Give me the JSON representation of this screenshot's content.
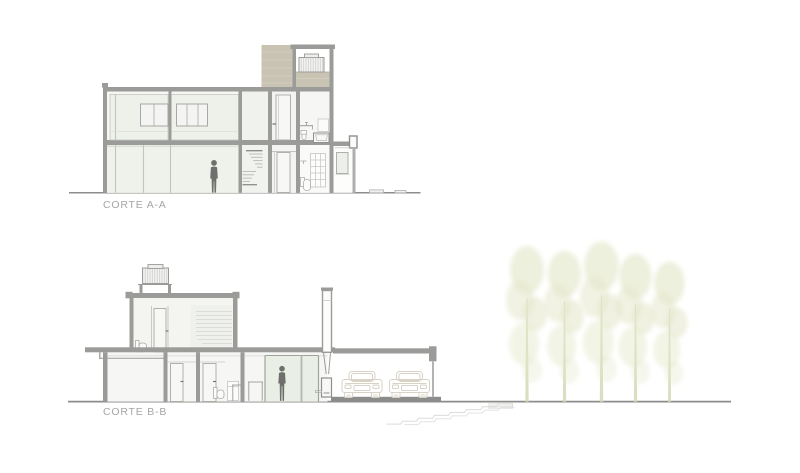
{
  "page": {
    "background": "#ffffff",
    "kind": "architectural-sections-sheet"
  },
  "sections": [
    {
      "id": "corte-aa",
      "label": "CORTE A-A"
    },
    {
      "id": "corte-bb",
      "label": "CORTE B-B"
    }
  ],
  "palette": {
    "wall": "#9b9b99",
    "wall_dark": "#8c8c8a",
    "ground_line": "#8c8c8a",
    "glass": "#edf1ea",
    "glass_green": "#e9efe5",
    "beige": "#c9c3b3",
    "beige_stripe": "#d6d0c2",
    "outline": "#a8a8a6",
    "outline_light": "#c9c9c7",
    "faint": "#dcdcda",
    "person": "#6f6f6d",
    "car_outline": "#d8d3c5",
    "tree_foliage": "#e3e6c8",
    "tree_trunk": "#d3d6b2",
    "label_text": "#a6a6a4"
  }
}
